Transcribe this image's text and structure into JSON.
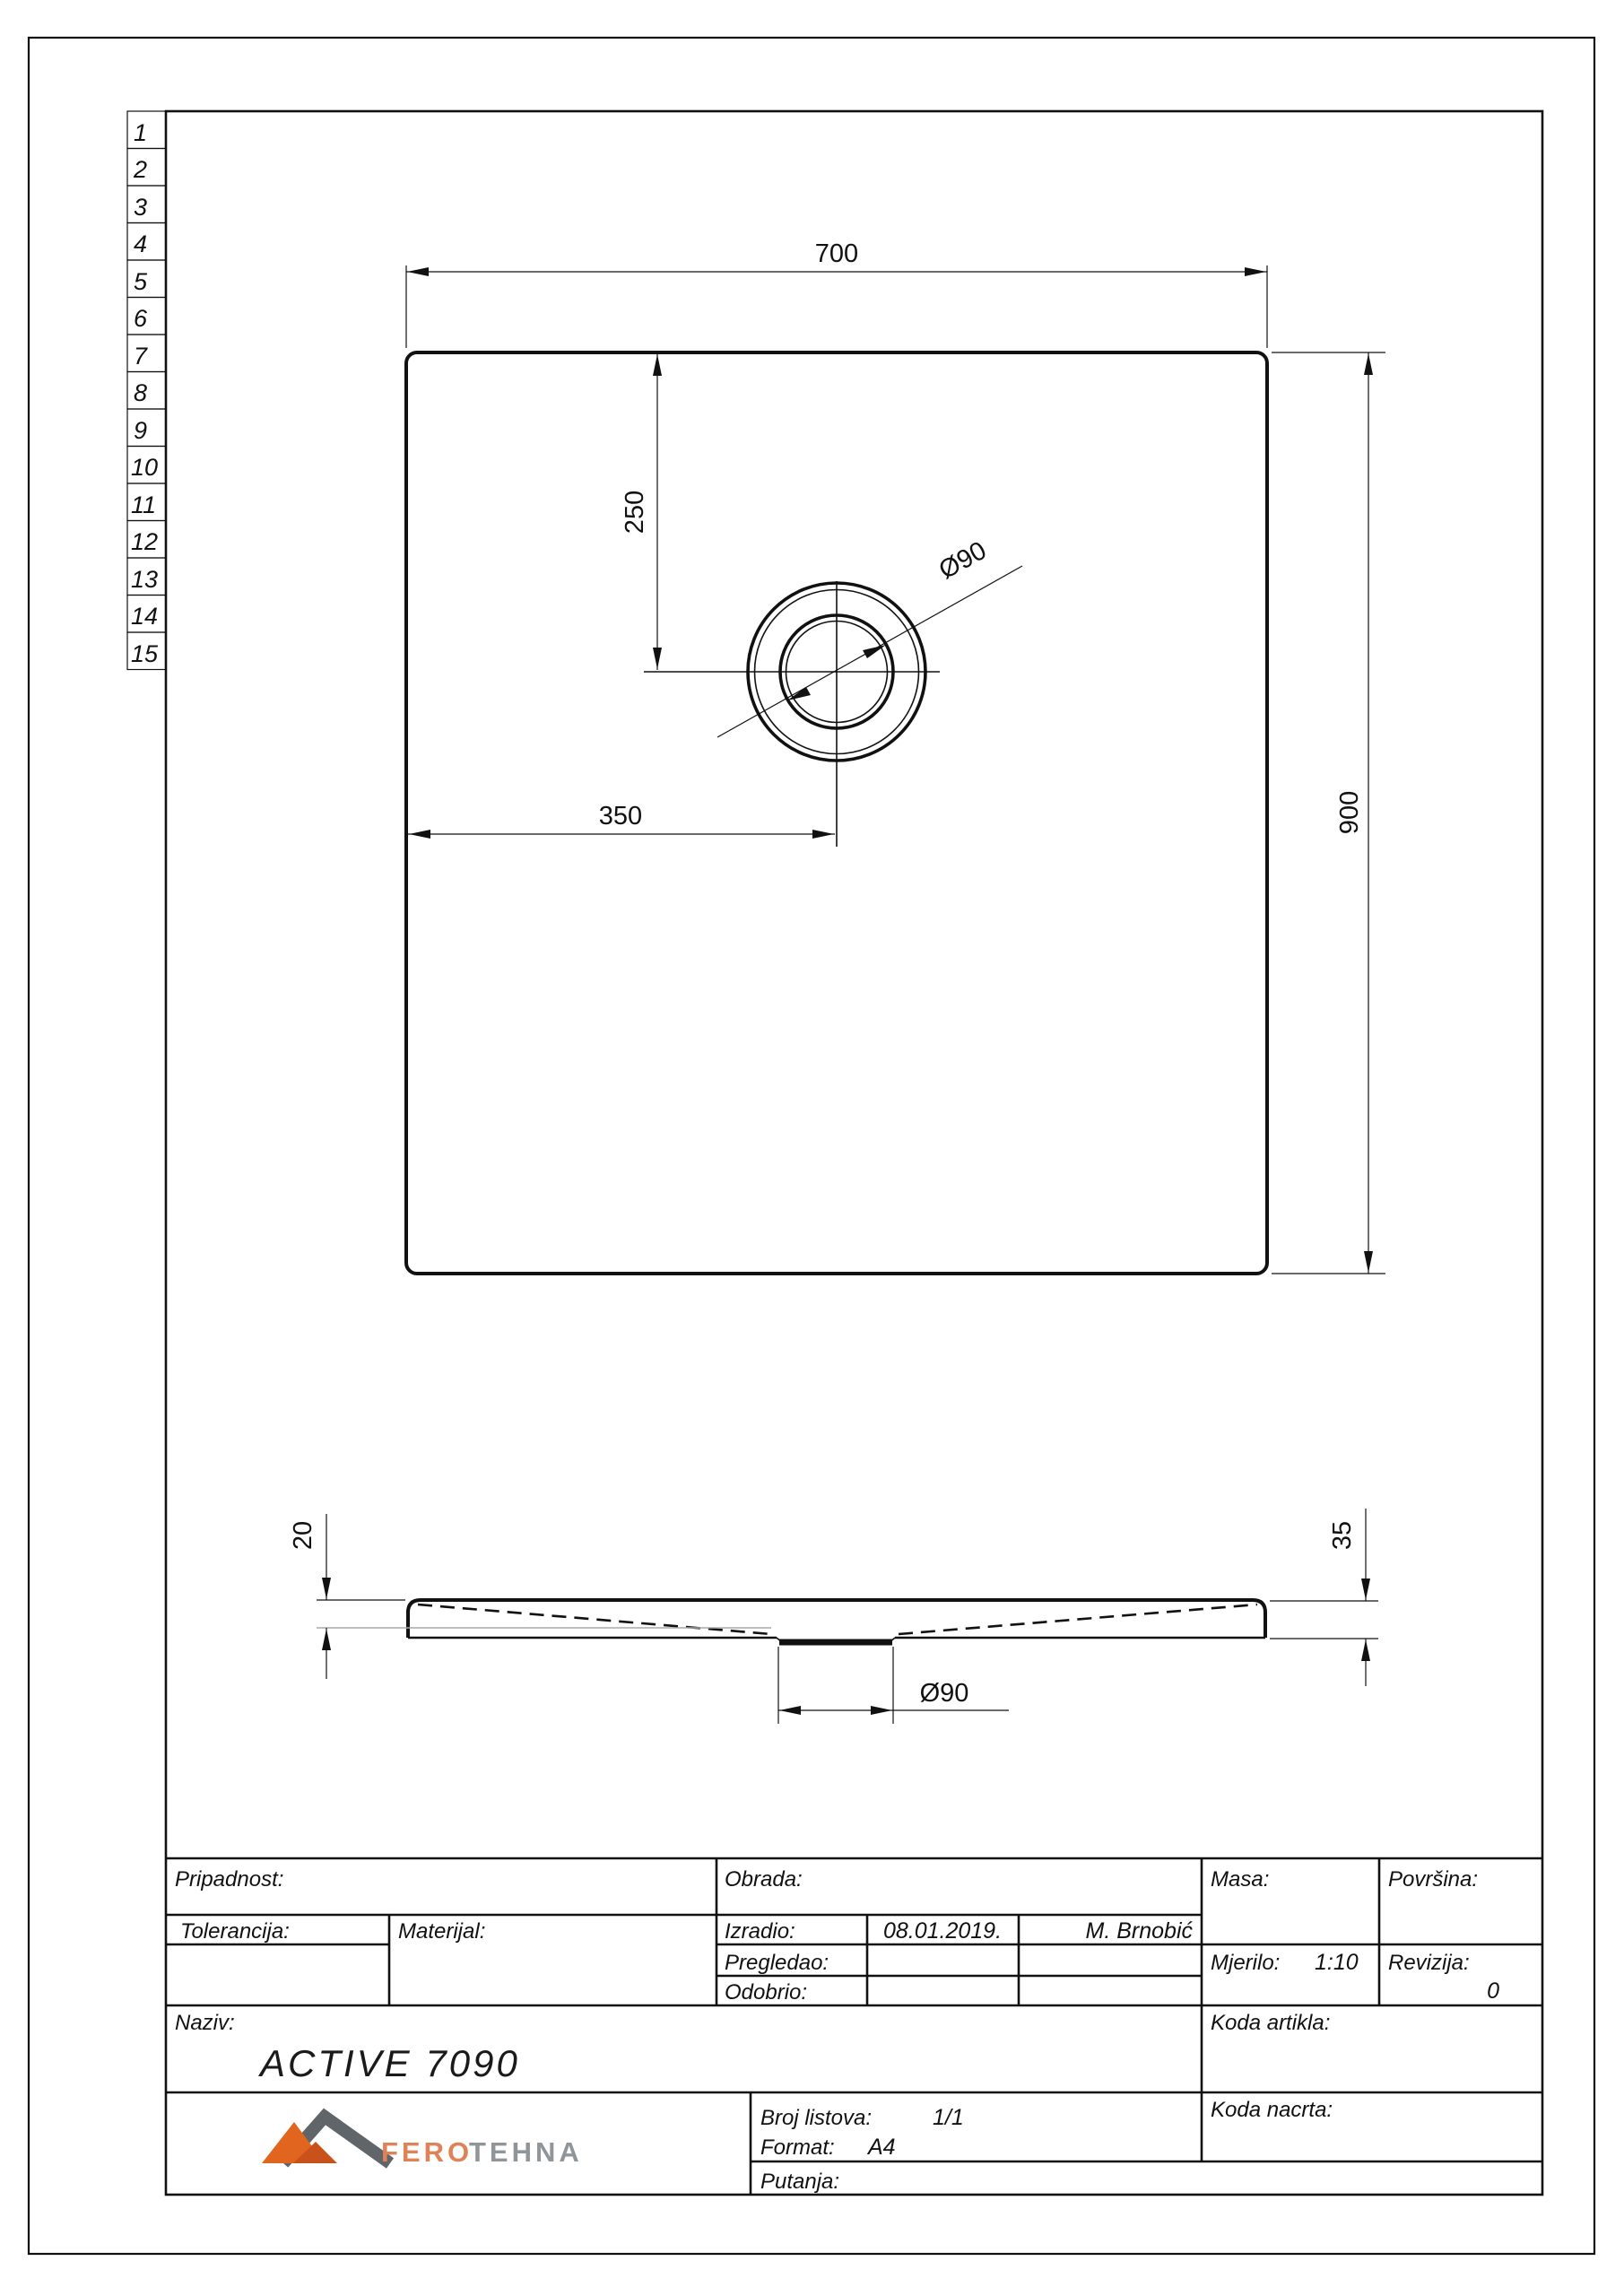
{
  "row_numbers": [
    "1",
    "2",
    "3",
    "4",
    "5",
    "6",
    "7",
    "8",
    "9",
    "10",
    "11",
    "12",
    "13",
    "14",
    "15"
  ],
  "dims": {
    "width": "700",
    "height": "900",
    "offset_x": "350",
    "offset_y": "250",
    "drain_top": "Ø90",
    "drain_bottom": "Ø90",
    "edge_thickness": "20",
    "total_height": "35"
  },
  "title_block": {
    "pripadnost_label": "Pripadnost:",
    "obrada_label": "Obrada:",
    "masa_label": "Masa:",
    "povrsina_label": "Površina:",
    "tolerancija_label": "Tolerancija:",
    "materijal_label": "Materijal:",
    "izradio_label": "Izradio:",
    "izradio_date": "08.01.2019.",
    "izradio_name": "M. Brnobić",
    "pregledao_label": "Pregledao:",
    "odobrio_label": "Odobrio:",
    "mjerilo_label": "Mjerilo:",
    "mjerilo_value": "1:10",
    "revizija_label": "Revizija:",
    "revizija_value": "0",
    "naziv_label": "Naziv:",
    "naziv_value": "ACTIVE 7090",
    "koda_artikla_label": "Koda artikla:",
    "koda_nacrta_label": "Koda nacrta:",
    "broj_listova_label": "Broj listova:",
    "broj_listova_value": "1/1",
    "format_label": "Format:",
    "format_value": "A4",
    "putanja_label": "Putanja:"
  },
  "logo": {
    "fero": "FERO",
    "tehna": "TEHNA",
    "orange": "#e2651f",
    "dark_orange": "#c9511b",
    "gray": "#5f6569",
    "fero_text_color": "#e08257",
    "tehna_text_color": "#8f9598"
  }
}
